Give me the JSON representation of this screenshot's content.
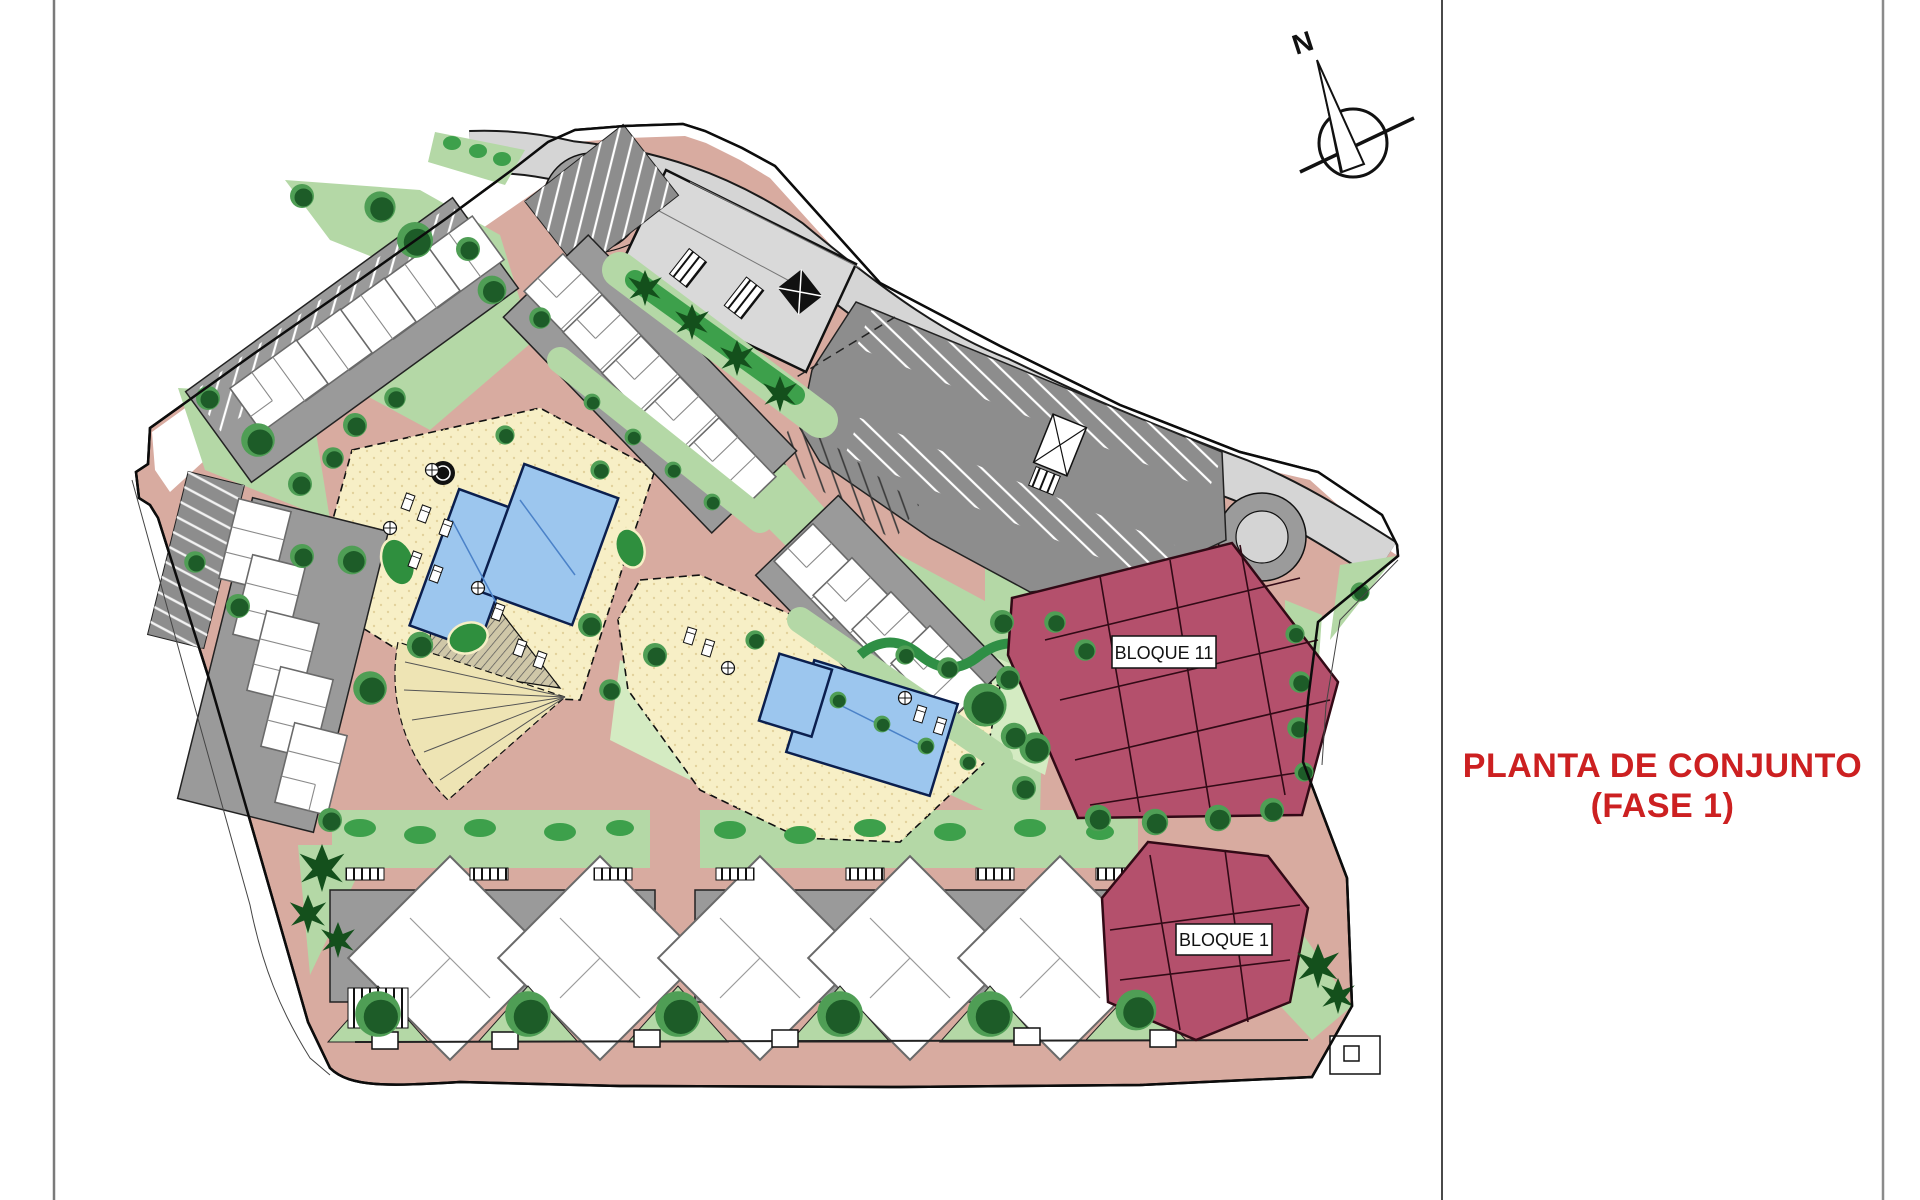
{
  "title": {
    "line1": "PLANTA DE CONJUNTO",
    "line2": "(FASE 1)",
    "color": "#cc2021"
  },
  "compass": {
    "label": "N"
  },
  "plan": {
    "labels": {
      "bloque11": "BLOQUE 11",
      "bloque1": "BLOQUE 1"
    },
    "colors": {
      "path_salmon": "#d8aba0",
      "lawn_green": "#b4d8a6",
      "pale_lawn": "#d4ebc2",
      "hedge_green": "#3da04b",
      "tree_dark": "#1d5c28",
      "pool_blue": "#9cc6ee",
      "deck_cream": "#f7efc6",
      "road_gray": "#d5d5d5",
      "parking_gray": "#8d8d8d",
      "building_gray": "#d9d9d9",
      "block_maroon": "#b4506c",
      "boundary": "#0c0c0c"
    }
  }
}
